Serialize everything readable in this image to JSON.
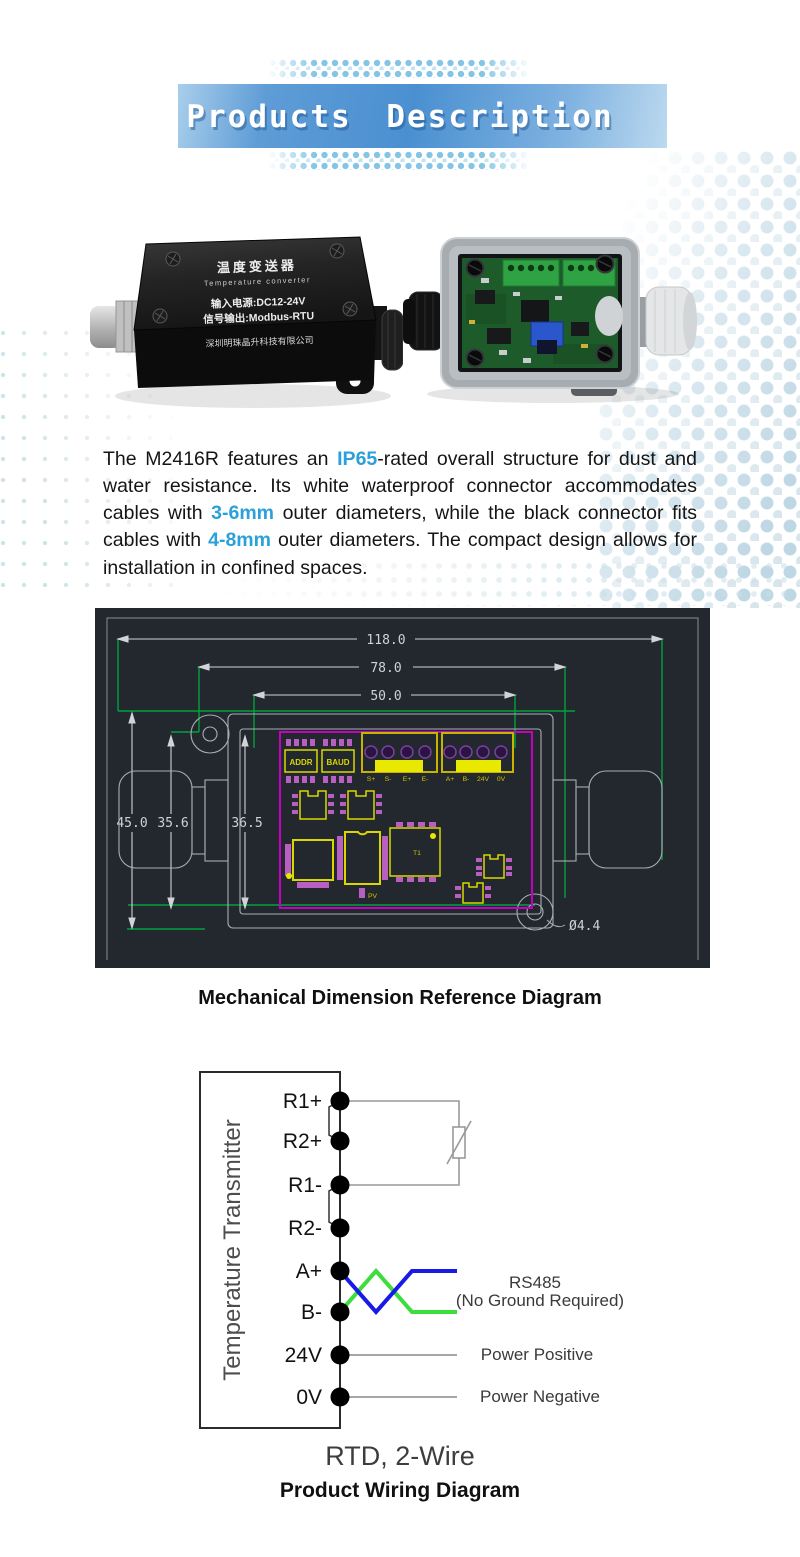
{
  "banner": {
    "title": "Products Description"
  },
  "photos": {
    "left": {
      "line1": "温度变送器",
      "line2": "Temperature converter",
      "line3": "输入电源:DC12-24V",
      "line4": "信号输出:Modbus-RTU",
      "line5": "深圳明珠晶升科技有限公司"
    }
  },
  "description": {
    "segments": [
      {
        "text": "The M2416R features an "
      },
      {
        "text": "IP65",
        "accent": true
      },
      {
        "text": "-rated overall structure for dust and water resistance. Its white waterproof connector accommodates cables with "
      },
      {
        "text": "3-6mm",
        "accent": true
      },
      {
        "text": " outer diameters, while the black connector fits cables with "
      },
      {
        "text": "4-8mm",
        "accent": true
      },
      {
        "text": " outer diameters. The compact design allows for installation in confined spaces."
      }
    ]
  },
  "mech": {
    "caption": "Mechanical Dimension Reference Diagram",
    "dims": {
      "overall_width": "118.0",
      "body_width": "78.0",
      "pcb_width": "50.0",
      "overall_height": "45.0",
      "inner_height_left": "35.6",
      "inner_height": "36.5",
      "hole_diameter": "Ø4.4"
    },
    "chips": {
      "addr": "ADDR",
      "baud": "BAUD",
      "t1": "T1",
      "pv": "PV"
    },
    "terminal_block1": [
      "S+",
      "S-",
      "E+",
      "E-"
    ],
    "terminal_block2": [
      "A+",
      "B-",
      "24V",
      "0V"
    ]
  },
  "wiring": {
    "device_label": "Temperature Transmitter",
    "terminals": [
      "R1+",
      "R2+",
      "R1-",
      "R2-",
      "A+",
      "B-",
      "24V",
      "0V"
    ],
    "rs485_label": "RS485",
    "rs485_note": "(No Ground Required)",
    "power_positive_label": "Power Positive",
    "power_negative_label": "Power Negative",
    "sensor_type_label": "RTD, 2-Wire",
    "caption": "Product Wiring Diagram"
  },
  "colors": {
    "accent_blue": "#2ba0da",
    "cad_green": "#00a33e",
    "cad_magenta": "#c400c4",
    "cad_yellow": "#d8d800",
    "wire_blue": "#1a1ae6",
    "wire_green": "#3ddd3d"
  }
}
